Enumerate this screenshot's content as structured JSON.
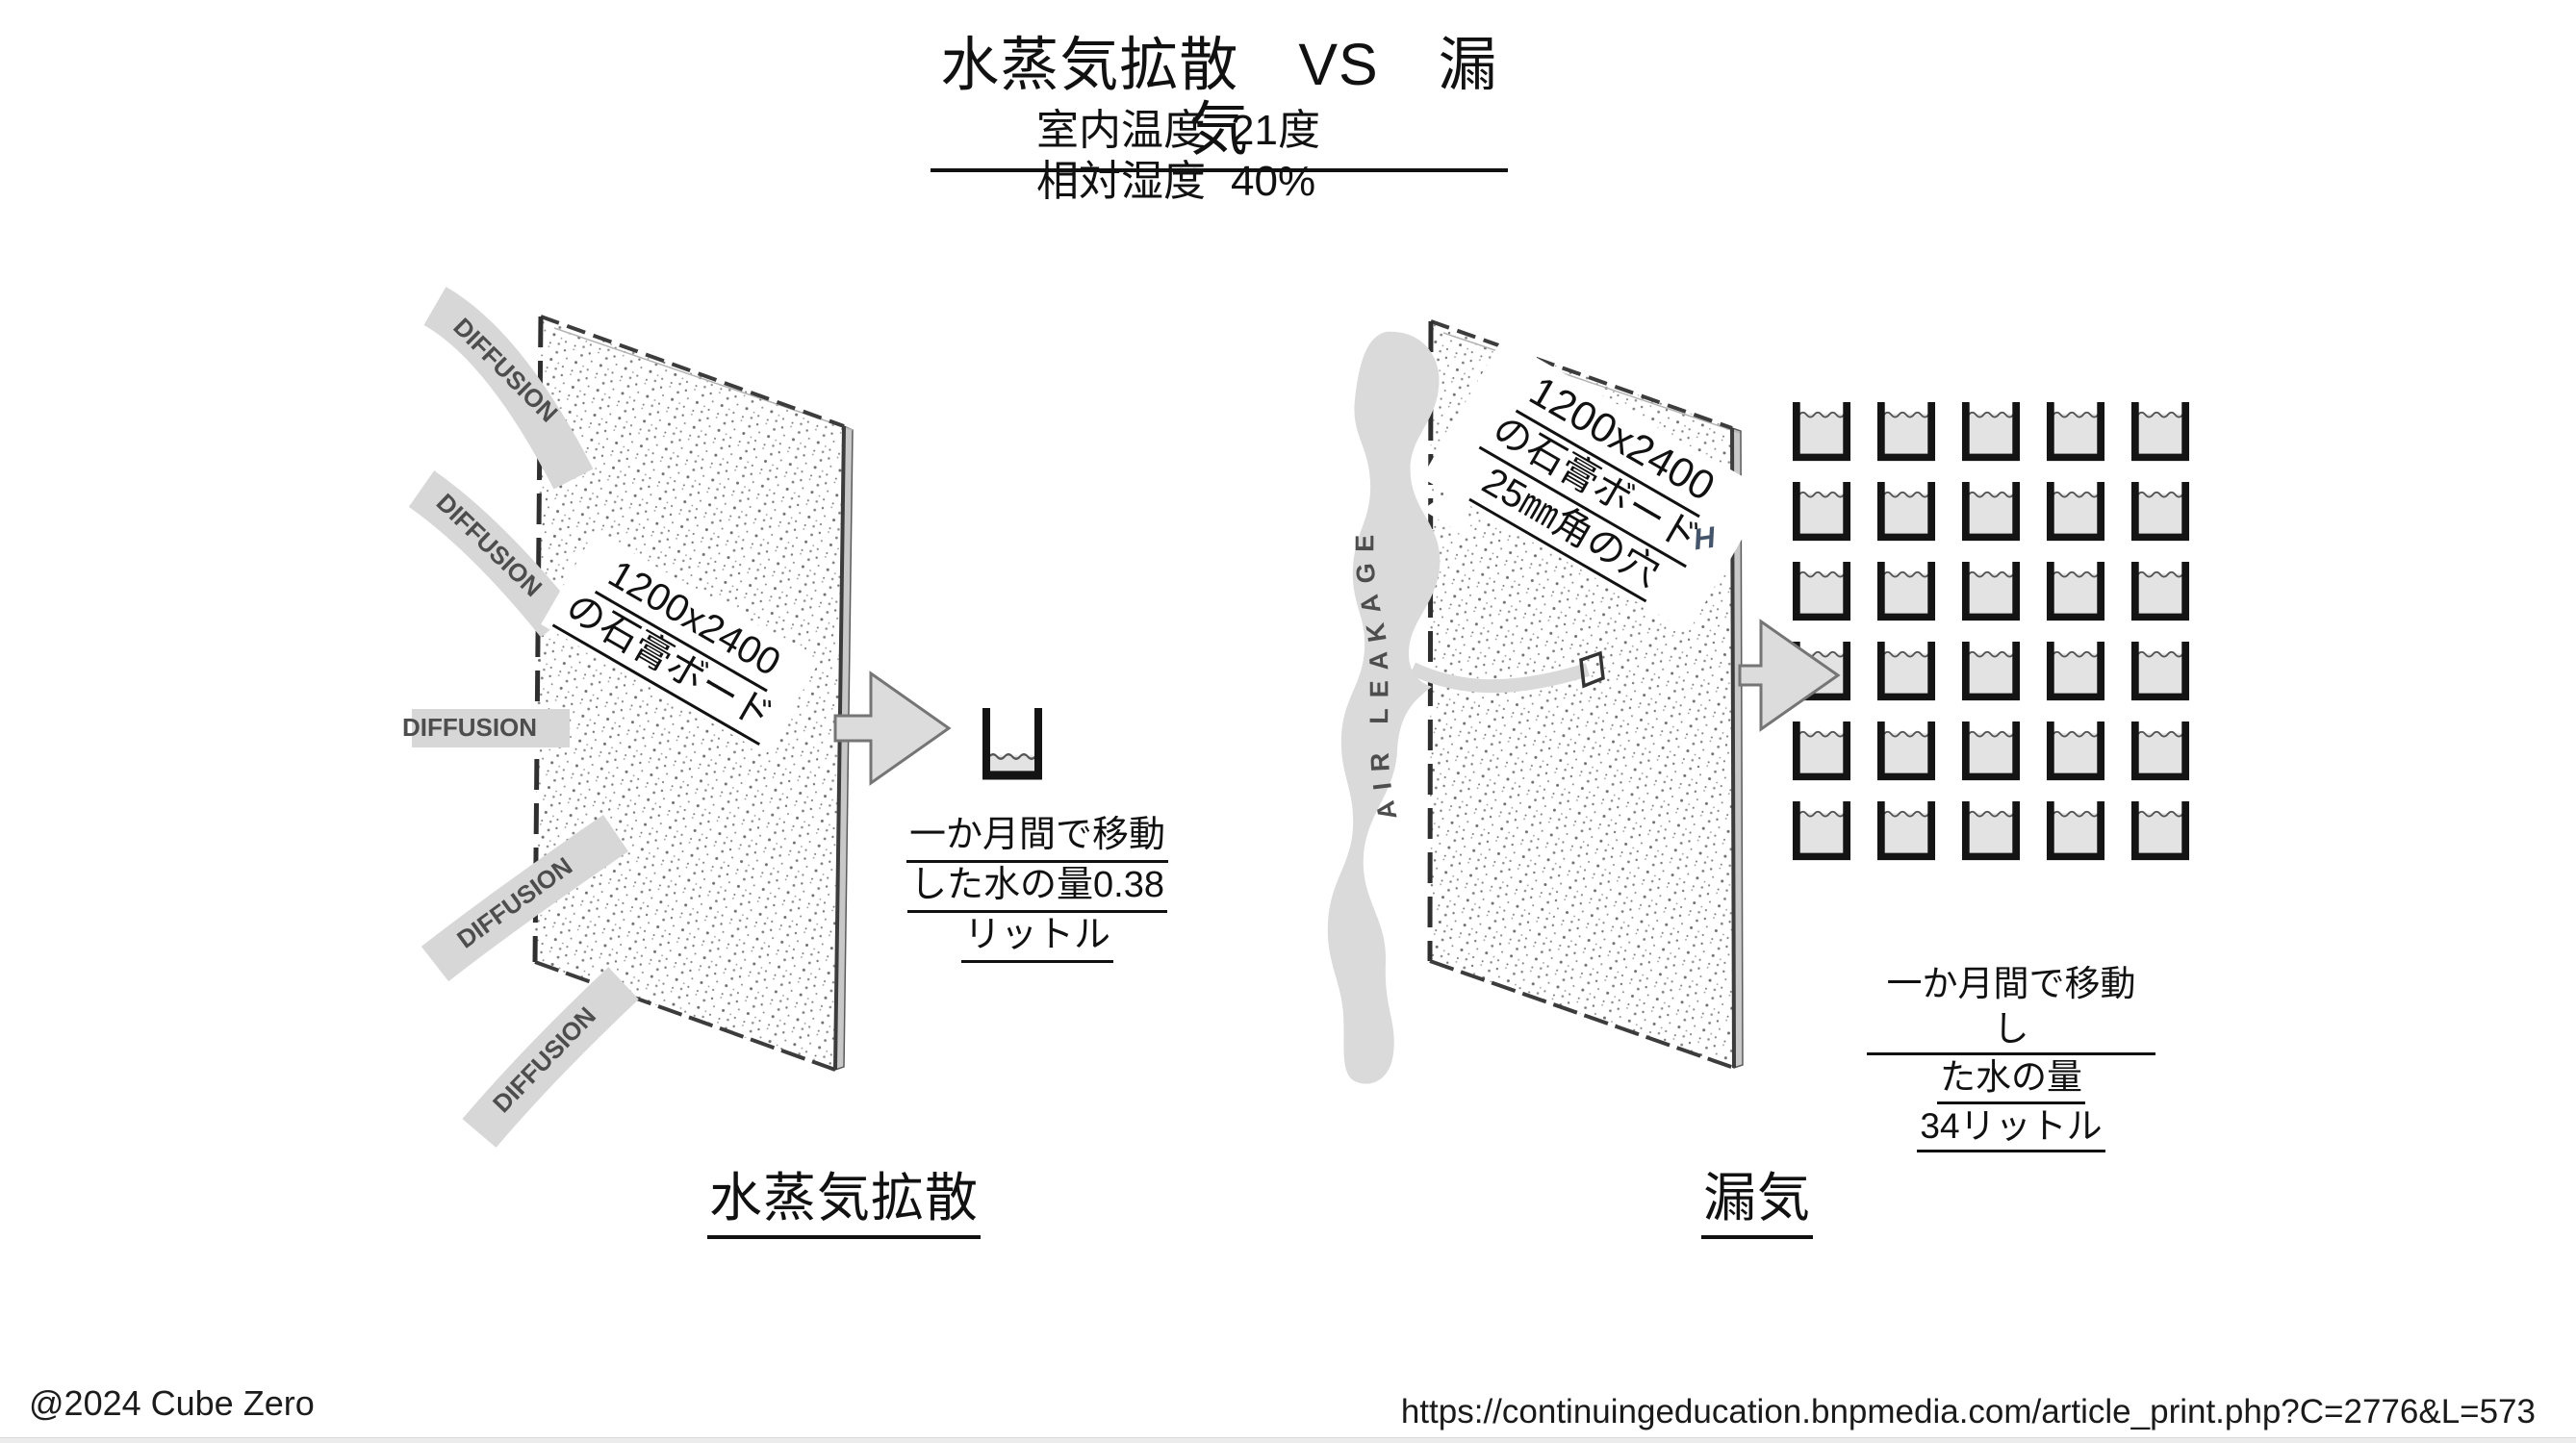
{
  "header": {
    "title": "水蒸気拡散　VS　漏気",
    "condition1_label": "室内温度",
    "condition1_value": "21度",
    "condition2_label": "相対湿度",
    "cond2_label": "相対湿度",
    "condition2_value": "40%"
  },
  "left_panel": {
    "caption": "水蒸気拡散",
    "board_label_line1": "1200x2400",
    "board_label_line2": "の石膏ボード",
    "diffusion_labels": [
      "DIFFUSION",
      "DIFFUSION",
      "DIFFUSION",
      "DIFFUSION",
      "DIFFUSION"
    ],
    "result_line1": "一か月間で移動",
    "result_line2": "した水の量0.38",
    "result_line3": "リットル",
    "cup_count": 1
  },
  "right_panel": {
    "caption": "漏気",
    "board_label_line1": "1200x2400",
    "board_label_line2": "の石膏ボード",
    "board_label_line3": "25㎜角の穴",
    "air_leakage_label": "AIR LEAKAGE",
    "h_mark": "H",
    "result_line1": "一か月間で移動し",
    "result_line2": "た水の量",
    "result_line3": "34リットル",
    "cup_grid": {
      "rows": 6,
      "cols": 5,
      "count": 30
    }
  },
  "footer": {
    "copyright": "@2024 Cube Zero",
    "url": "https://continuingeducation.bnpmedia.com/article_print.php?C=2776&L=573"
  }
}
